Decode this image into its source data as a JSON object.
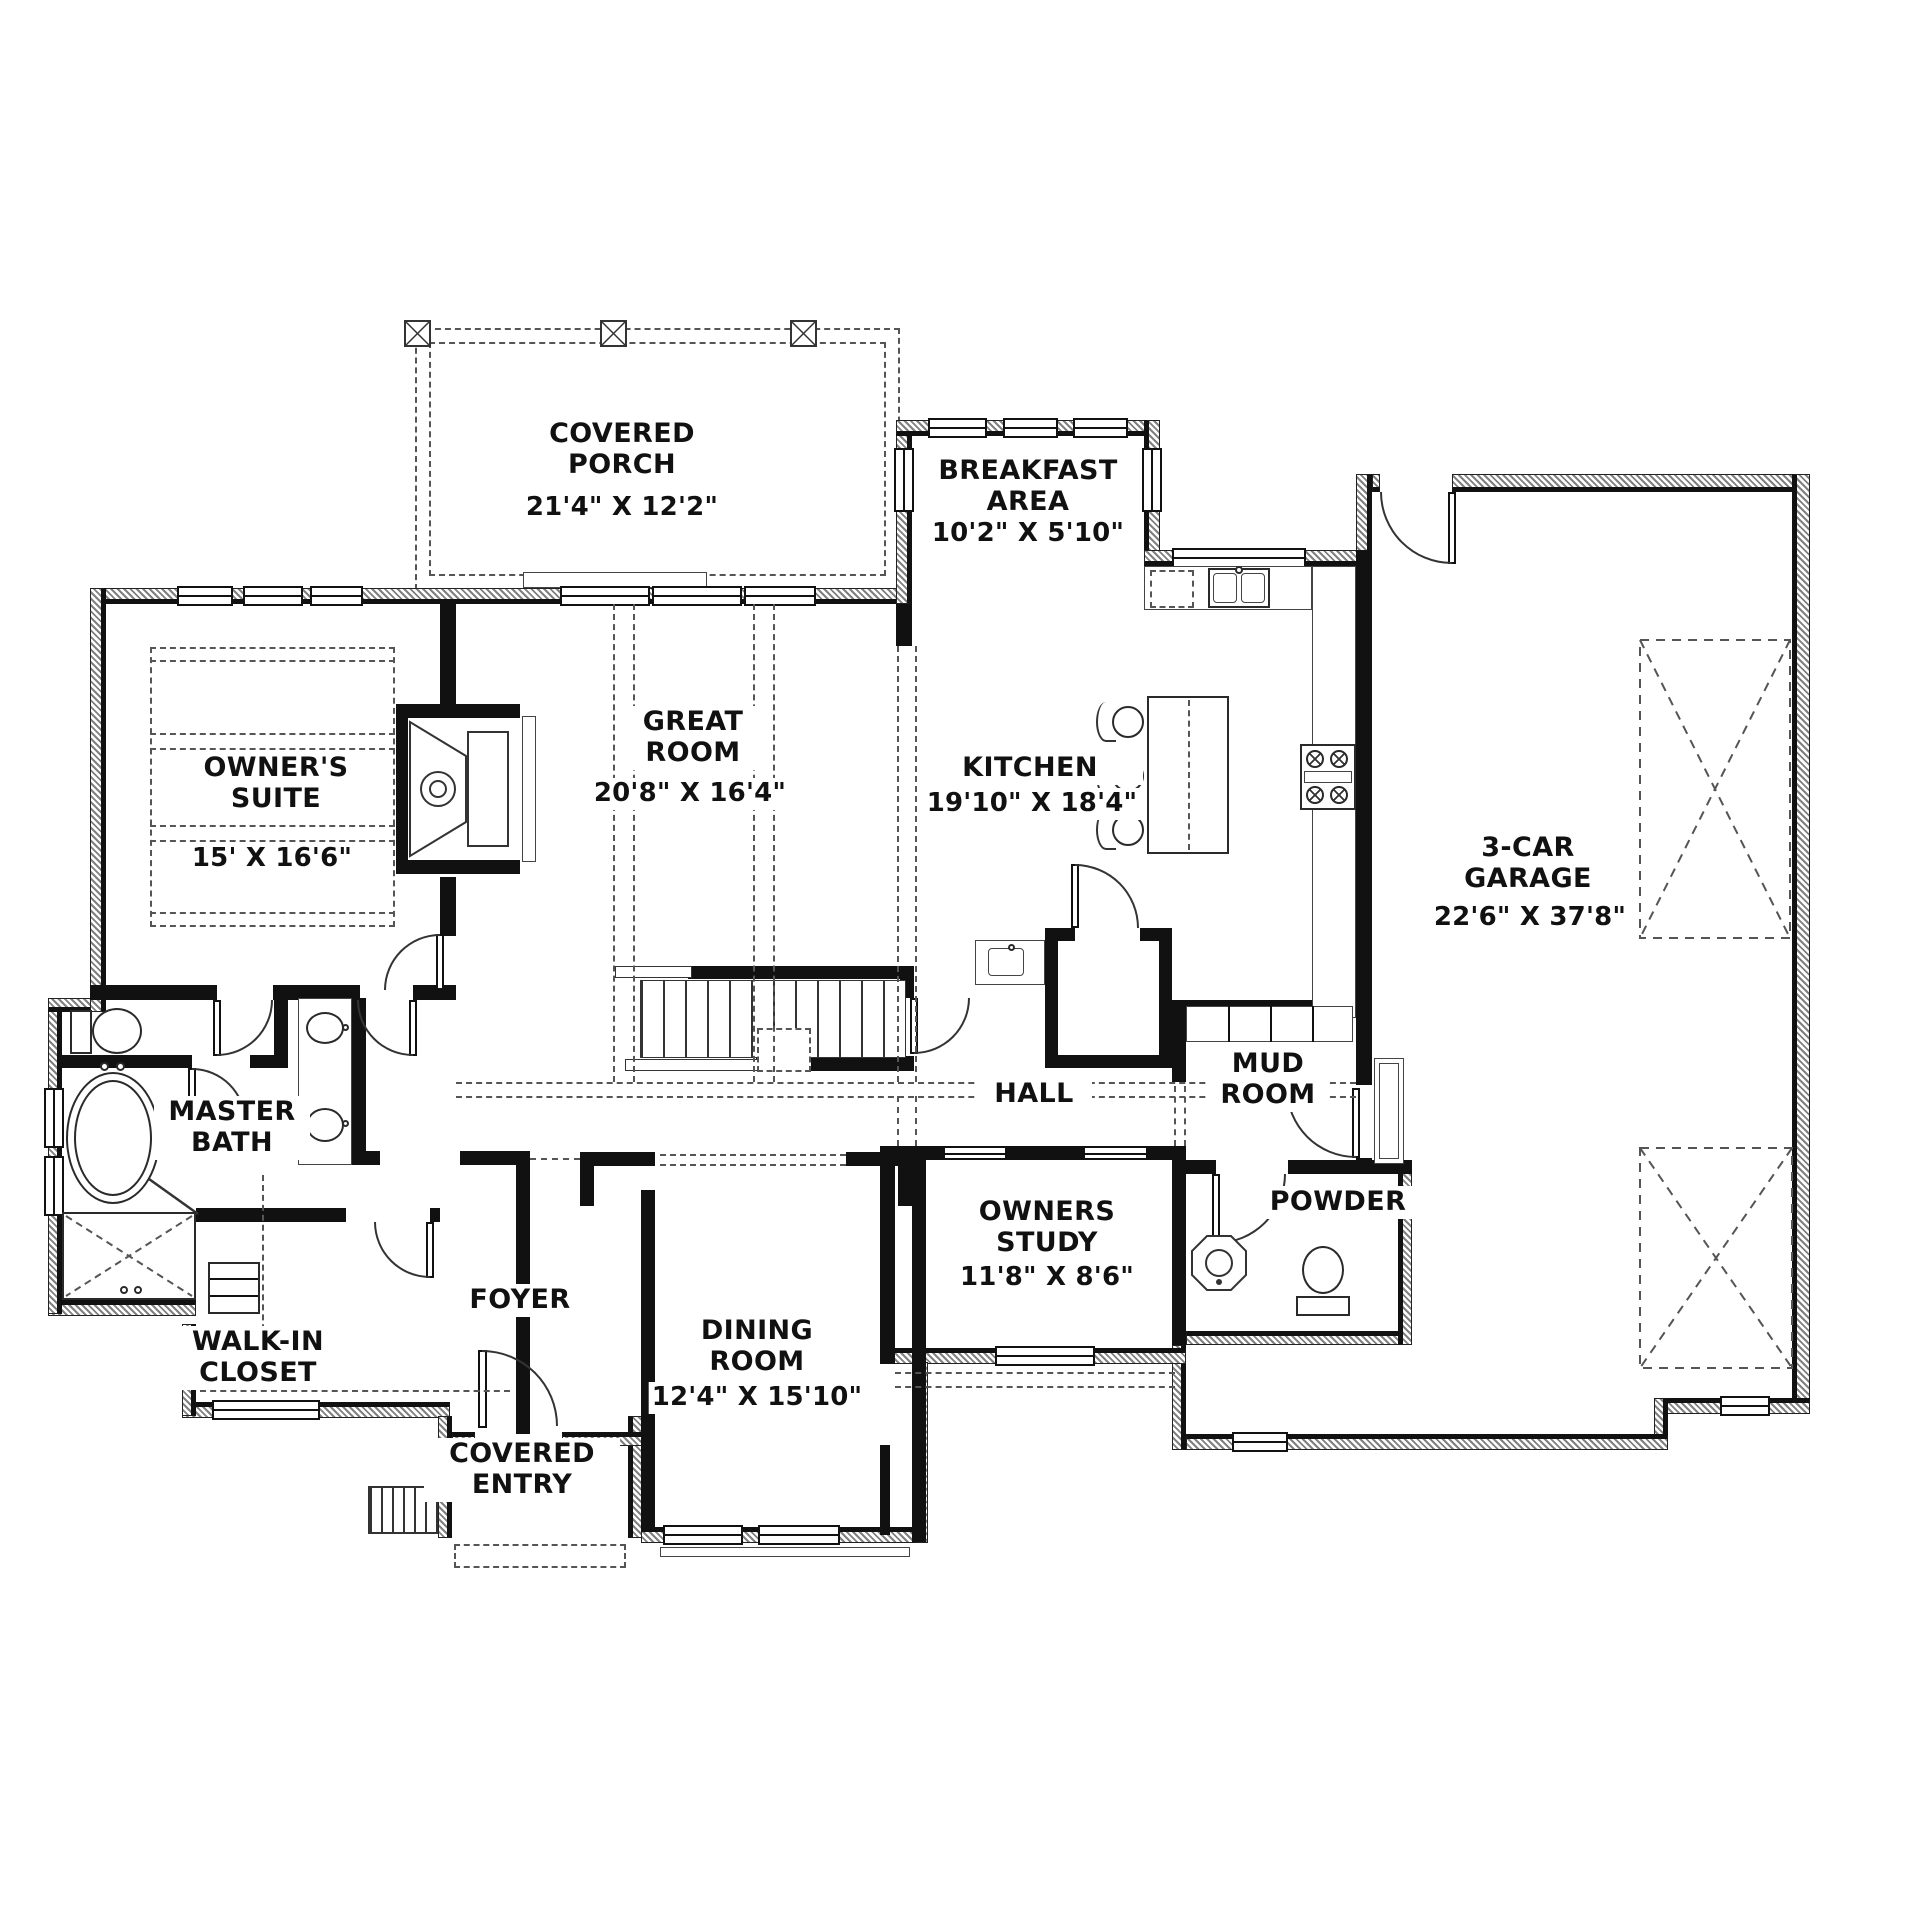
{
  "document": {
    "type": "first-floor plan drawing"
  },
  "colors": {
    "wall": "#111111",
    "line": "#333333",
    "paper": "#ffffff"
  },
  "rooms": {
    "covered_porch": {
      "name": "COVERED PORCH",
      "dims": "21'4\" X 12'2\""
    },
    "breakfast_area": {
      "name": "BREAKFAST AREA",
      "dims": "10'2\" X 5'10\""
    },
    "owners_suite": {
      "name": "OWNER'S SUITE",
      "dims": "15' X 16'6\""
    },
    "great_room": {
      "name": "GREAT ROOM",
      "dims": "20'8\" X 16'4\""
    },
    "kitchen": {
      "name": "KITCHEN",
      "dims": "19'10\" X 18'4\""
    },
    "garage": {
      "name": "3-CAR GARAGE",
      "dims": "22'6\" X 37'8\""
    },
    "master_bath": {
      "name": "MASTER BATH"
    },
    "walk_in_closet": {
      "name": "WALK-IN CLOSET"
    },
    "foyer": {
      "name": "FOYER"
    },
    "dining_room": {
      "name": "DINING ROOM",
      "dims": "12'4\" X 15'10\""
    },
    "hall": {
      "name": "HALL"
    },
    "mud_room": {
      "name": "MUD ROOM"
    },
    "powder": {
      "name": "POWDER"
    },
    "owners_study": {
      "name": "OWNERS STUDY",
      "dims": "11'8\" X 8'6\""
    },
    "covered_entry": {
      "name": "COVERED ENTRY"
    }
  }
}
